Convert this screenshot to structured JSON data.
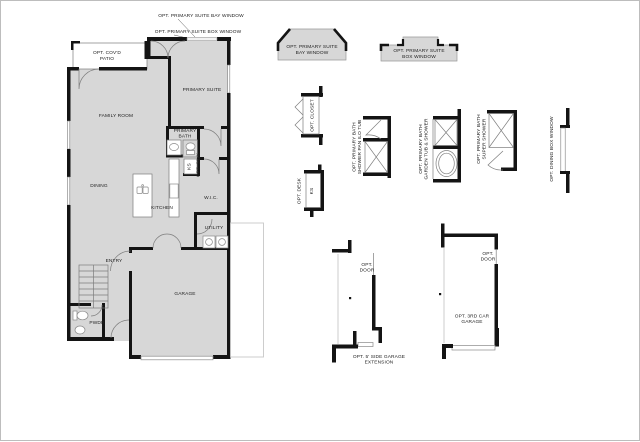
{
  "canvas": {
    "background": "#ffffff",
    "border_color": "#bdbdbd"
  },
  "colors": {
    "room_fill": "#d7d7d7",
    "wall": "#141414",
    "line": "#7d7d7d",
    "faint_option_line": "#c8c8c8",
    "text": "#222222"
  },
  "callouts": {
    "bay_window": "OPT. PRIMARY SUITE BAY WINDOW",
    "box_window": "OPT. PRIMARY SUITE BOX WINDOW"
  },
  "rooms": {
    "covd_patio": [
      "OPT. COV'D",
      "PATIO"
    ],
    "family_room": "FAMILY ROOM",
    "primary_suite": "PRIMARY SUITE",
    "primary_bath": [
      "PRIMARY",
      "BATH"
    ],
    "ks": "KS",
    "opt_sink": "OPT. SINK",
    "dining": "DINING",
    "kitchen": "KITCHEN",
    "wic": "W.I.C.",
    "utility": "UTILITY",
    "entry": "ENTRY",
    "garage": "GARAGE",
    "pwdr": "PWDR"
  },
  "option_details": {
    "bay_window": [
      "OPT. PRIMARY SUITE",
      "BAY WINDOW"
    ],
    "box_window": [
      "OPT. PRIMARY SUITE",
      "BOX WINDOW"
    ],
    "closet": "OPT. CLOSET",
    "desk": "OPT. DESK",
    "desk_ks": "KS",
    "shower_pan": [
      "OPT. PRIMARY BATH",
      "SHOWER PAN ILO TUB"
    ],
    "garden_tub": [
      "OPT. PRIMARY BATH",
      "GARDEN TUB & SHOWER"
    ],
    "super_shower": [
      "OPT. PRIMARY BATH",
      "SUPER SHOWER"
    ],
    "dining_box_window": "OPT. DINING BOX WINDOW",
    "side_door": [
      "OPT.",
      "DOOR"
    ],
    "side_garage_extension": [
      "OPT. 5' SIDE GARAGE",
      "EXTENSION"
    ],
    "third_car_door": [
      "OPT.",
      "DOOR"
    ],
    "third_car_garage": [
      "OPT. 3RD CAR",
      "GARAGE"
    ]
  }
}
